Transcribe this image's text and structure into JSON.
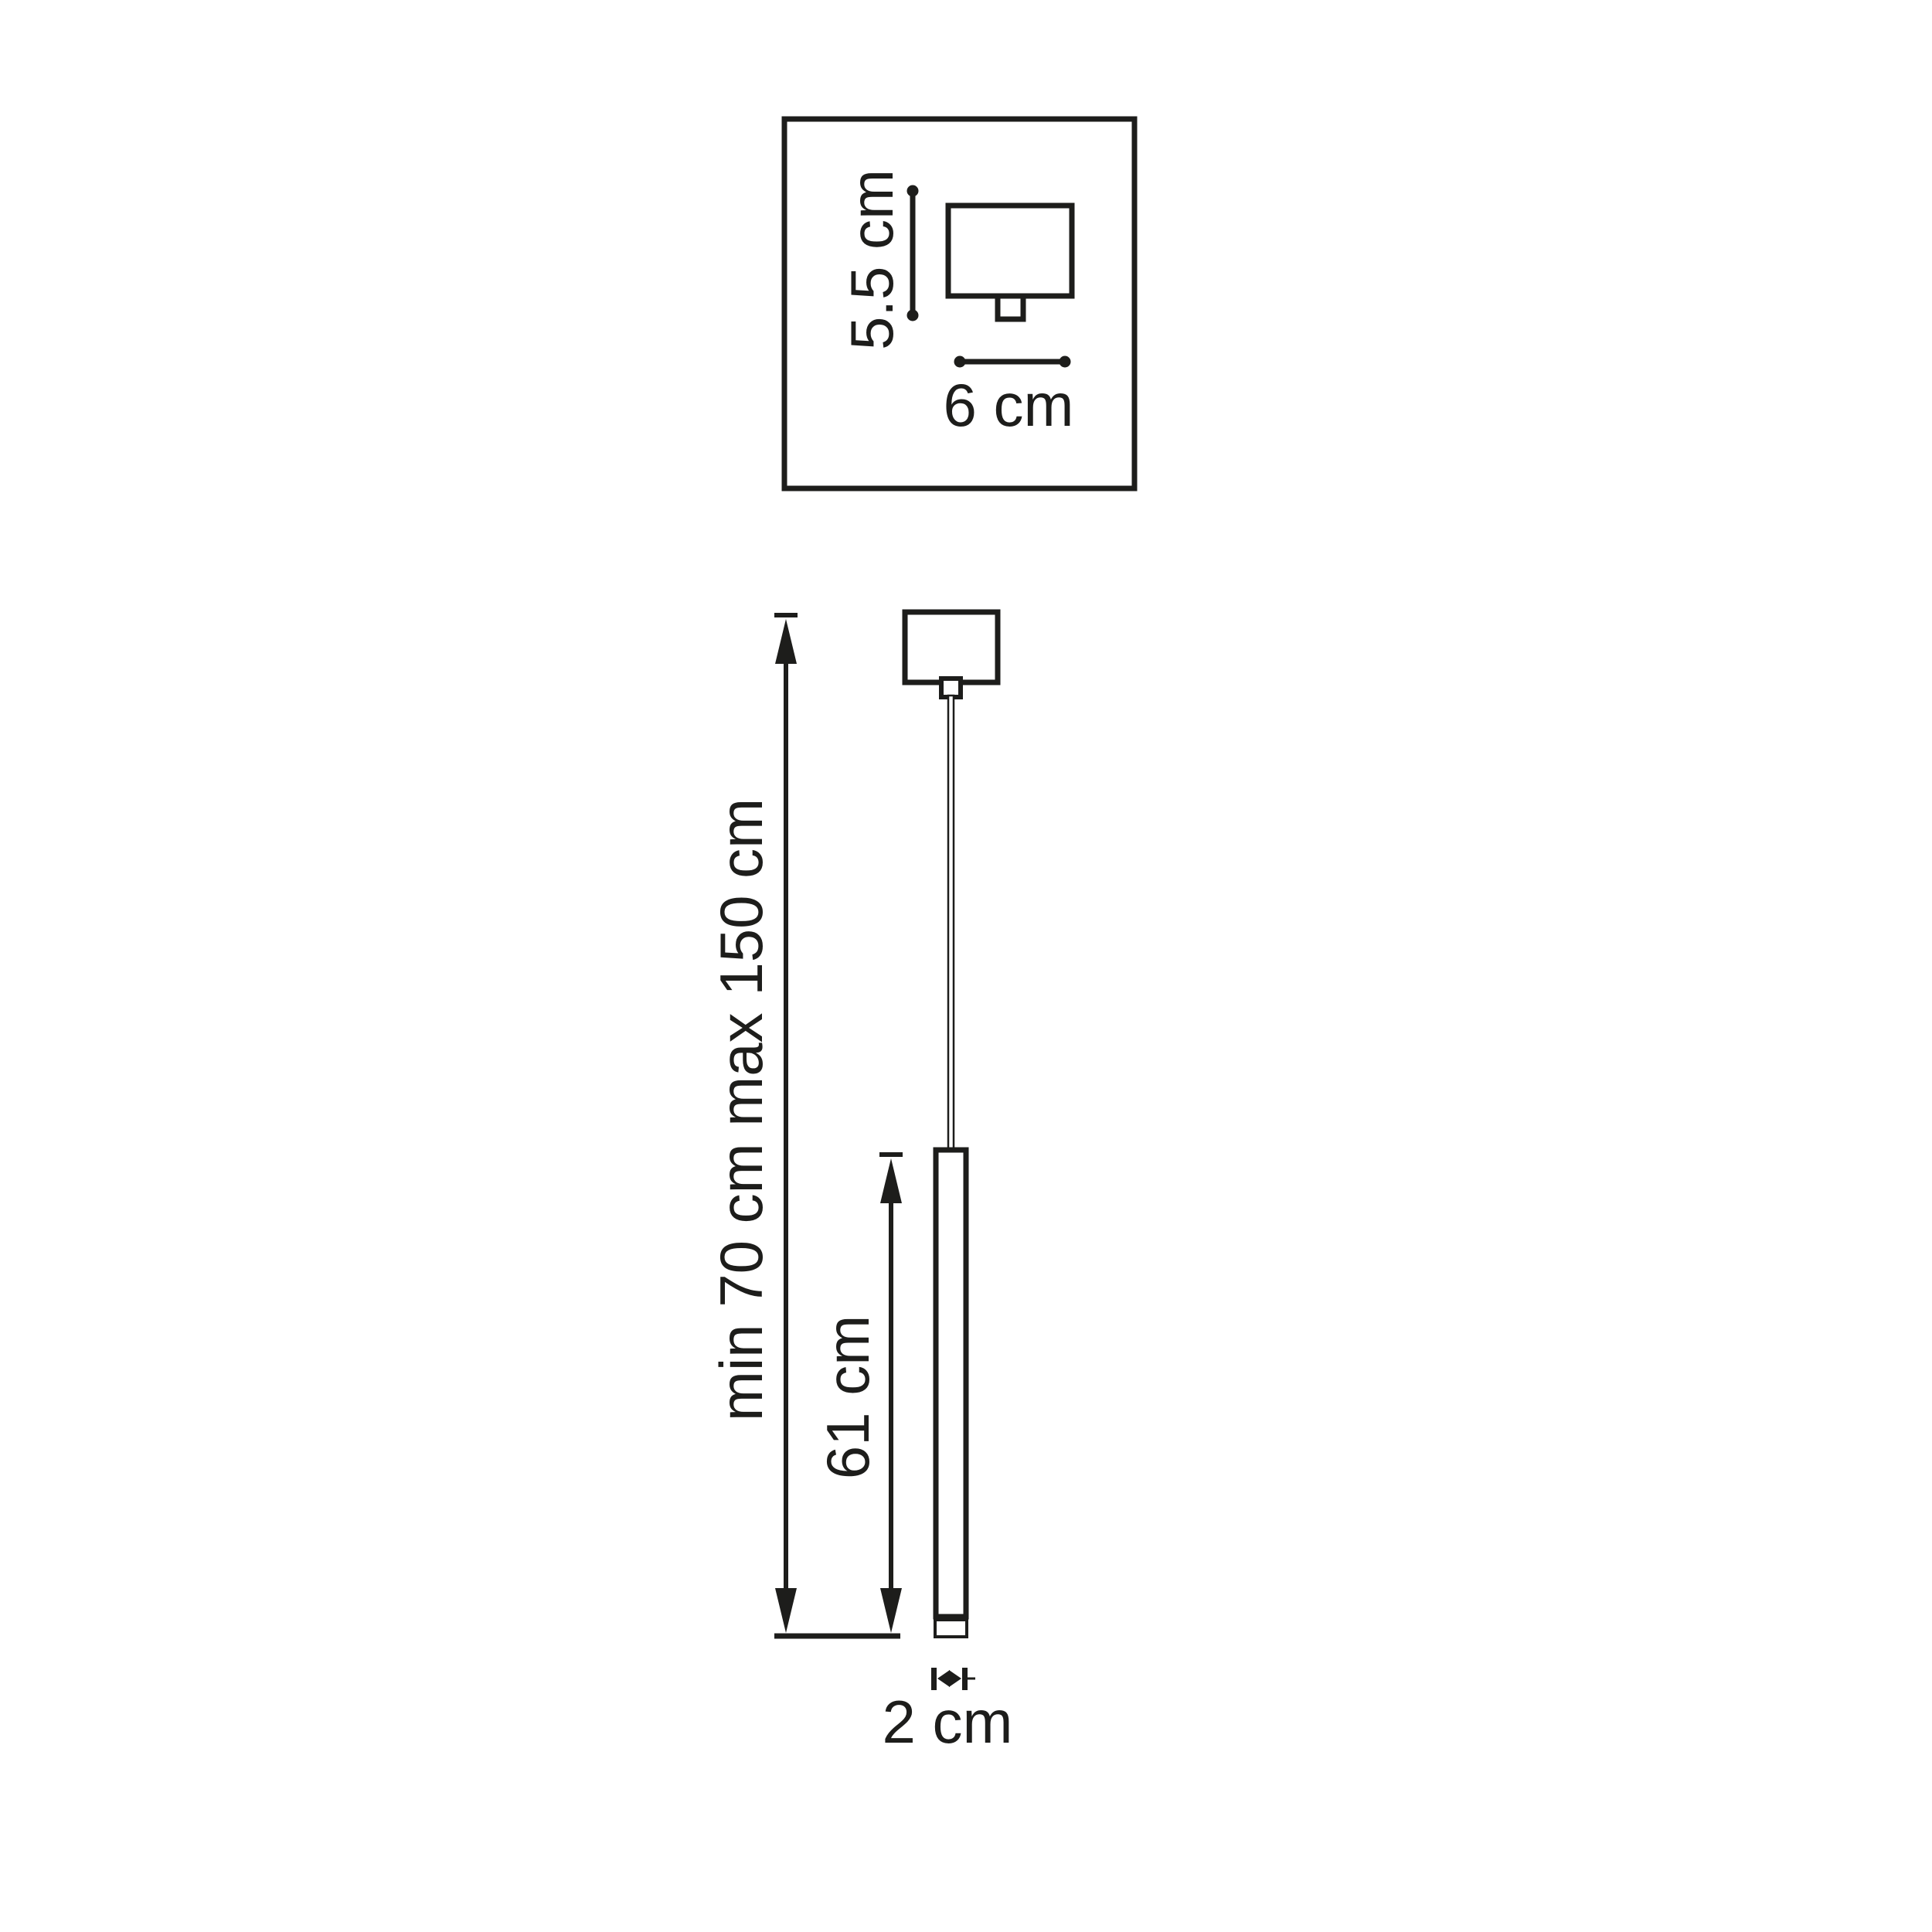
{
  "colors": {
    "ink": "#1d1d1b",
    "background": "#ffffff"
  },
  "spec_box": {
    "canopy_height_label": "5.5 cm",
    "canopy_width_label": "6 cm"
  },
  "pendant": {
    "overall_height_label": "min 70 cm max 150 cm",
    "fixture_height_label": "61 cm",
    "diameter_label": "2 cm"
  }
}
